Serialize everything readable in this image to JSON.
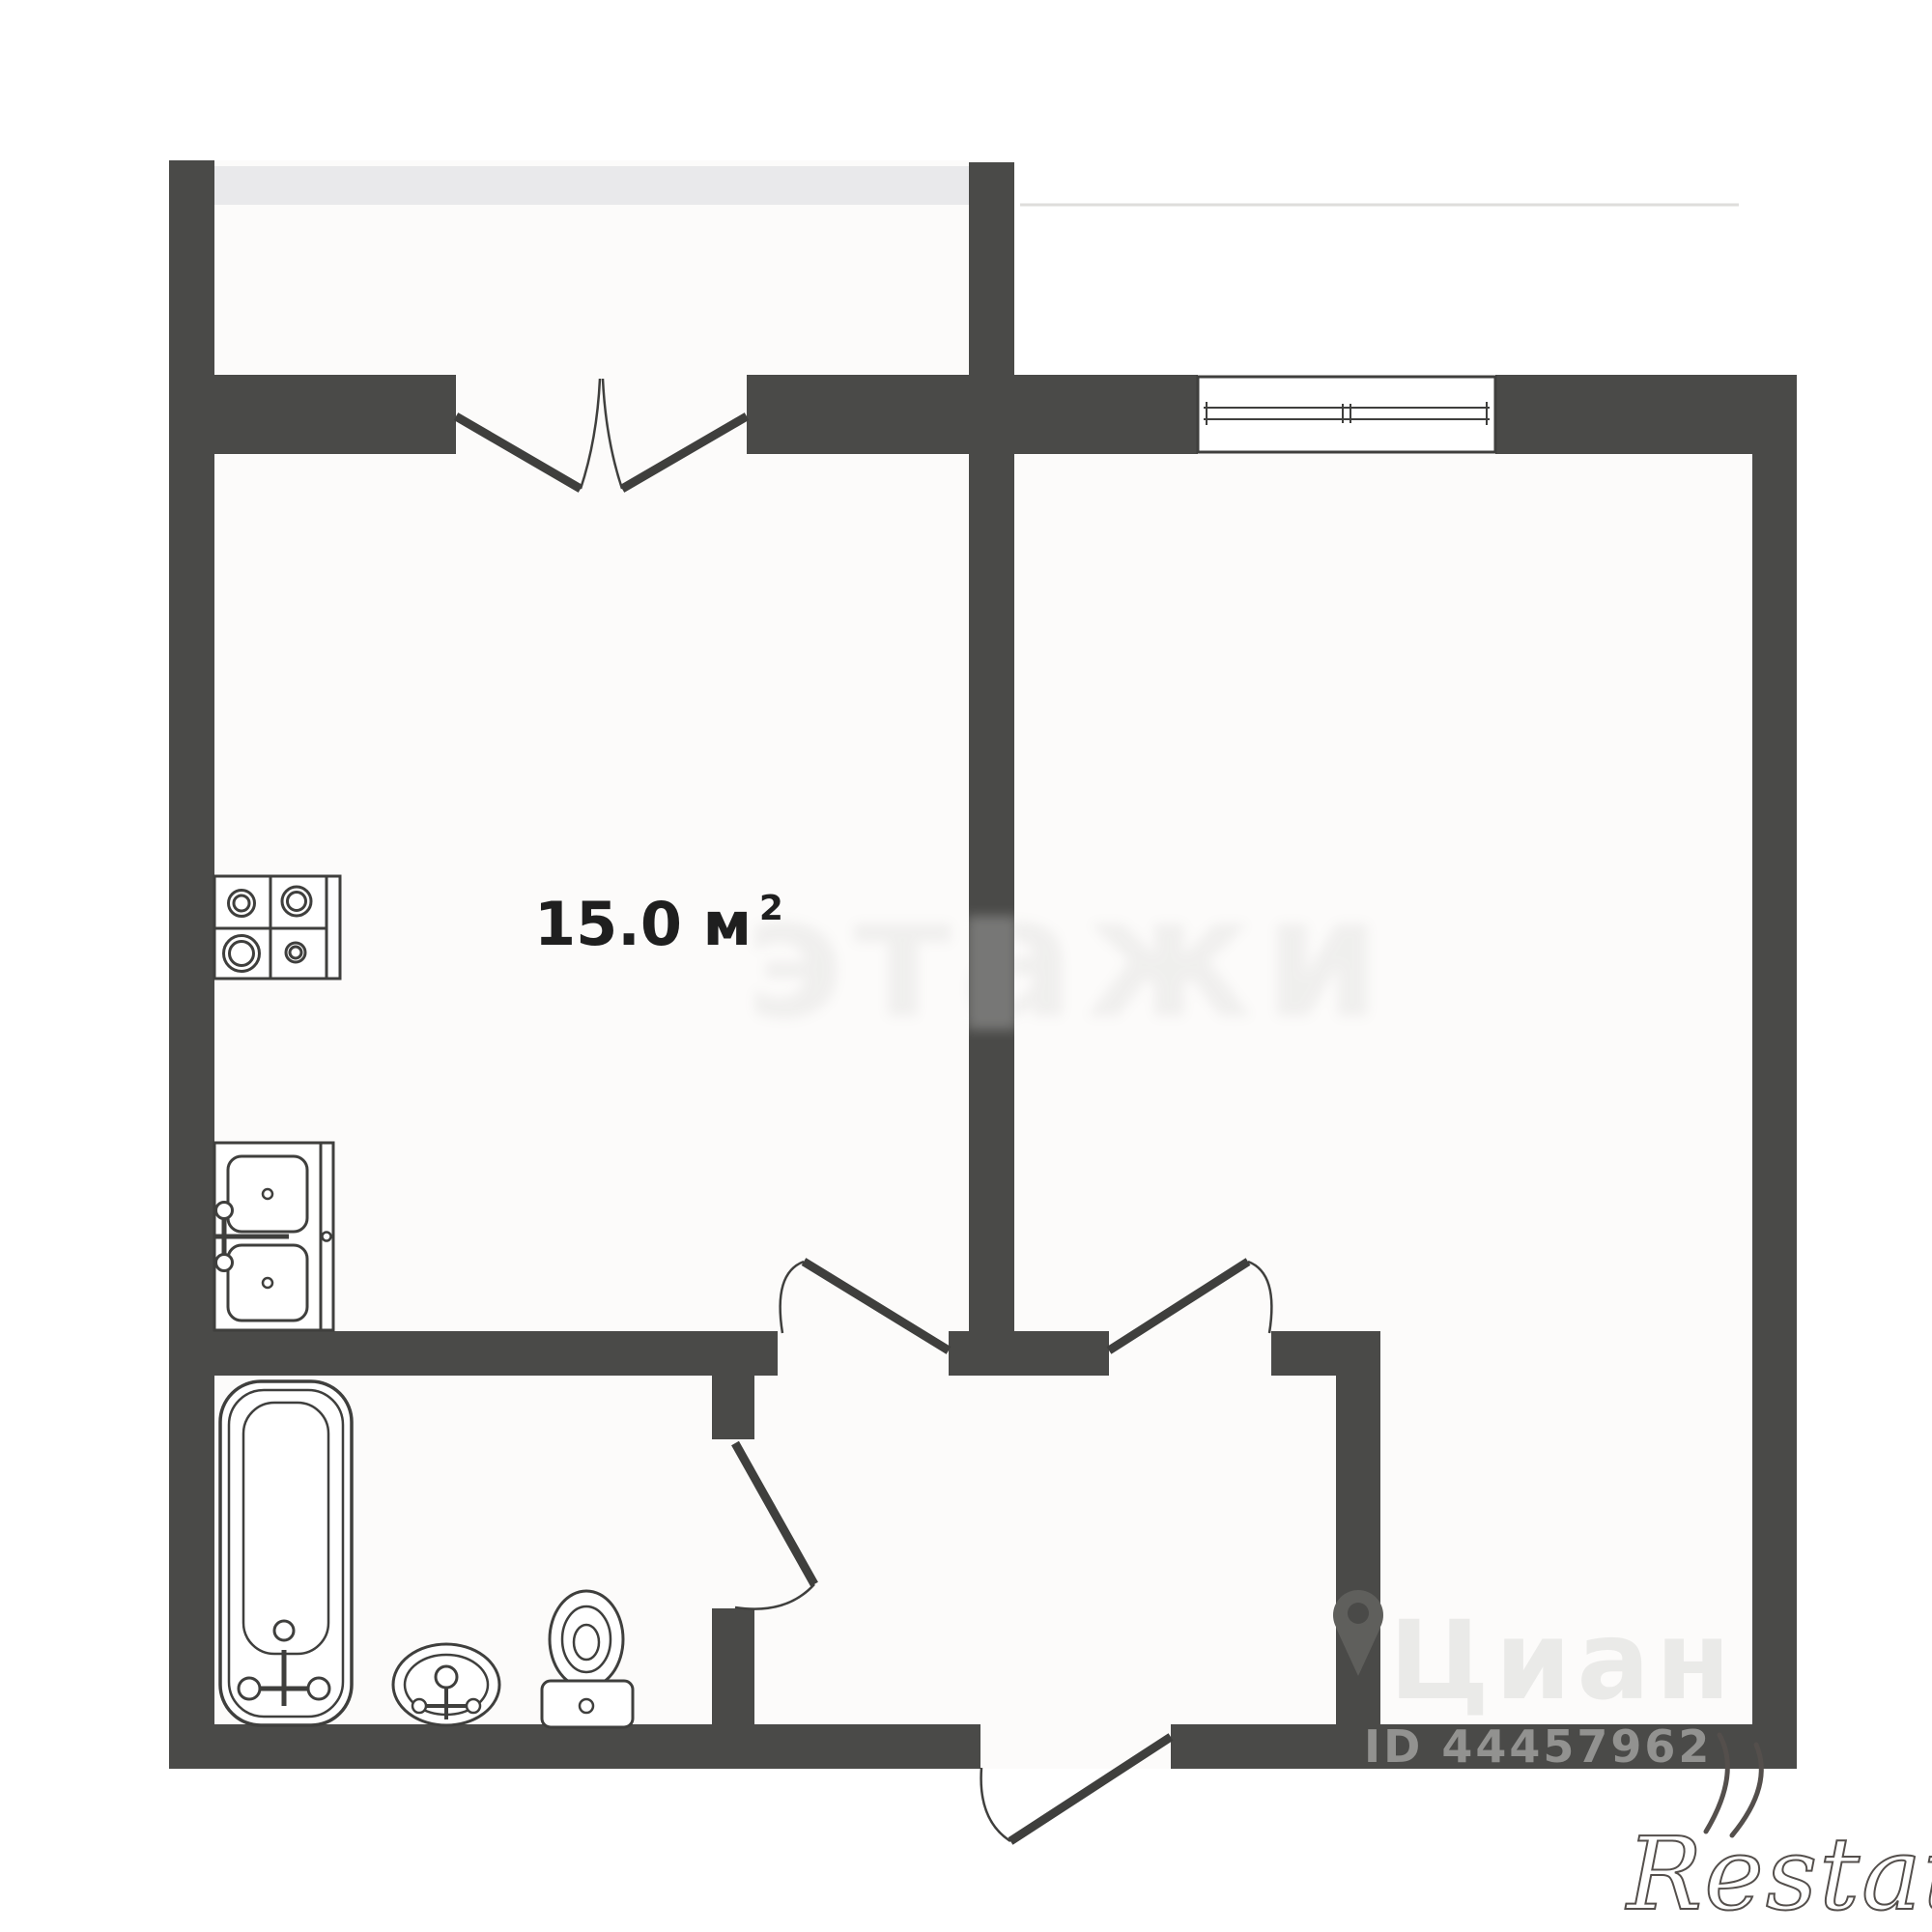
{
  "room": {
    "area_base": "15.0 м",
    "area_sup": "2"
  },
  "watermarks": {
    "center_text": "этажи",
    "portal_text": "Циан",
    "listing_id": "ID 44457962",
    "brand": "Restate"
  },
  "colors": {
    "wall": "#4a4a48",
    "outline": "#3f3f3d",
    "balcony_glass": "#e9e9eb",
    "room_fill": "#fcfbfa",
    "page_bg": "#ffffff",
    "faint_line": "#dedddb",
    "listing_id_text": "#9a9a98",
    "brand_stroke": "#544f4c",
    "portal_watermark": "#e9e9e7",
    "center_watermark": "#8a8a88",
    "pin_watermark": "#5f5f5c"
  }
}
